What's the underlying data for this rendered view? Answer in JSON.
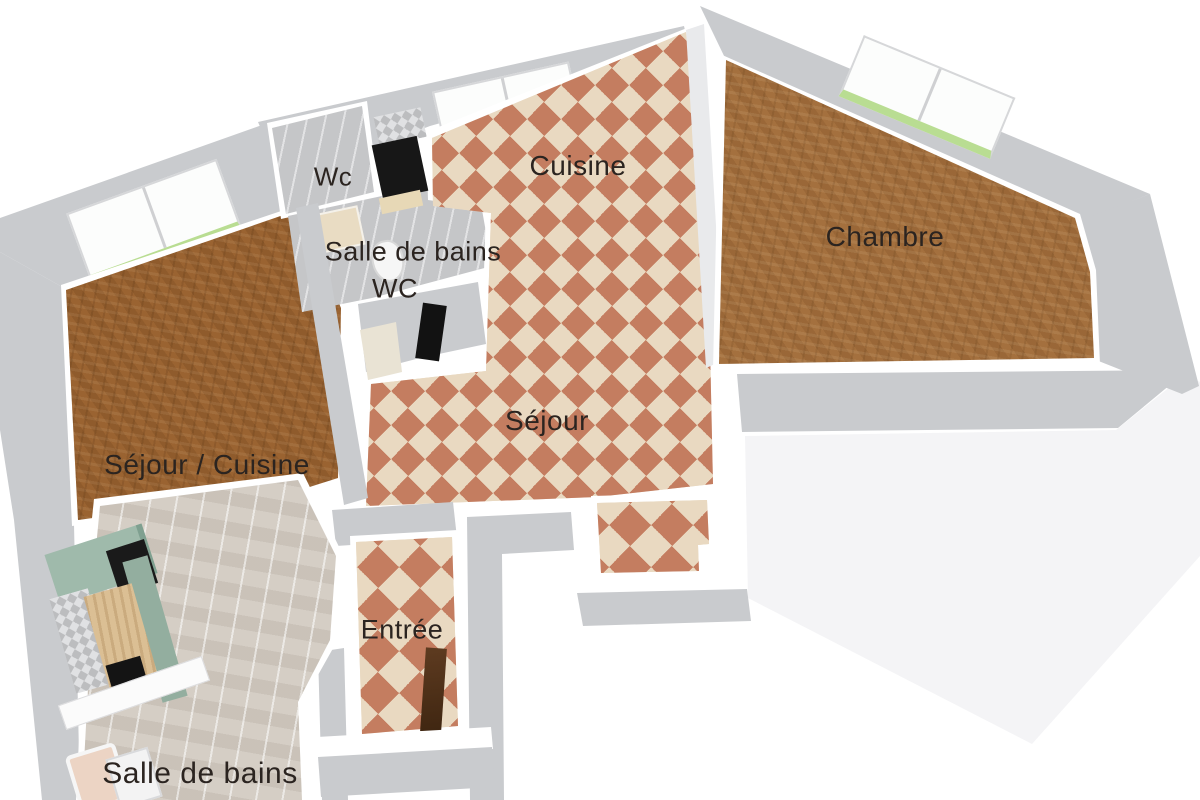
{
  "floorplan": {
    "type": "3d-floor-plan-top-view",
    "background": "#ffffff",
    "rooms": [
      {
        "id": "wc-top",
        "label": "Wc"
      },
      {
        "id": "salle-de-bains-upper",
        "label": "Salle de bains"
      },
      {
        "id": "wc-inner",
        "label": "WC"
      },
      {
        "id": "cuisine",
        "label": "Cuisine"
      },
      {
        "id": "chambre",
        "label": "Chambre"
      },
      {
        "id": "sejour",
        "label": "Séjour"
      },
      {
        "id": "sejour-cuisine",
        "label": "Séjour / Cuisine"
      },
      {
        "id": "entree",
        "label": "Entrée"
      },
      {
        "id": "salle-de-bains-lower",
        "label": "Salle de bains"
      }
    ],
    "colors": {
      "wall_gray": "#c9cbce",
      "tile_terracotta": "#c47d60",
      "tile_cream": "#e9d9c1",
      "wood_parquet": "#a4703e",
      "wood_parquet_dark": "#9a6331",
      "plank_floor": "#d5cec5",
      "cabinet_green": "#9fbaab",
      "window_sill_green": "#b9dd92",
      "door_brown": "#5e3b20",
      "label_text": "#2b2420"
    }
  }
}
